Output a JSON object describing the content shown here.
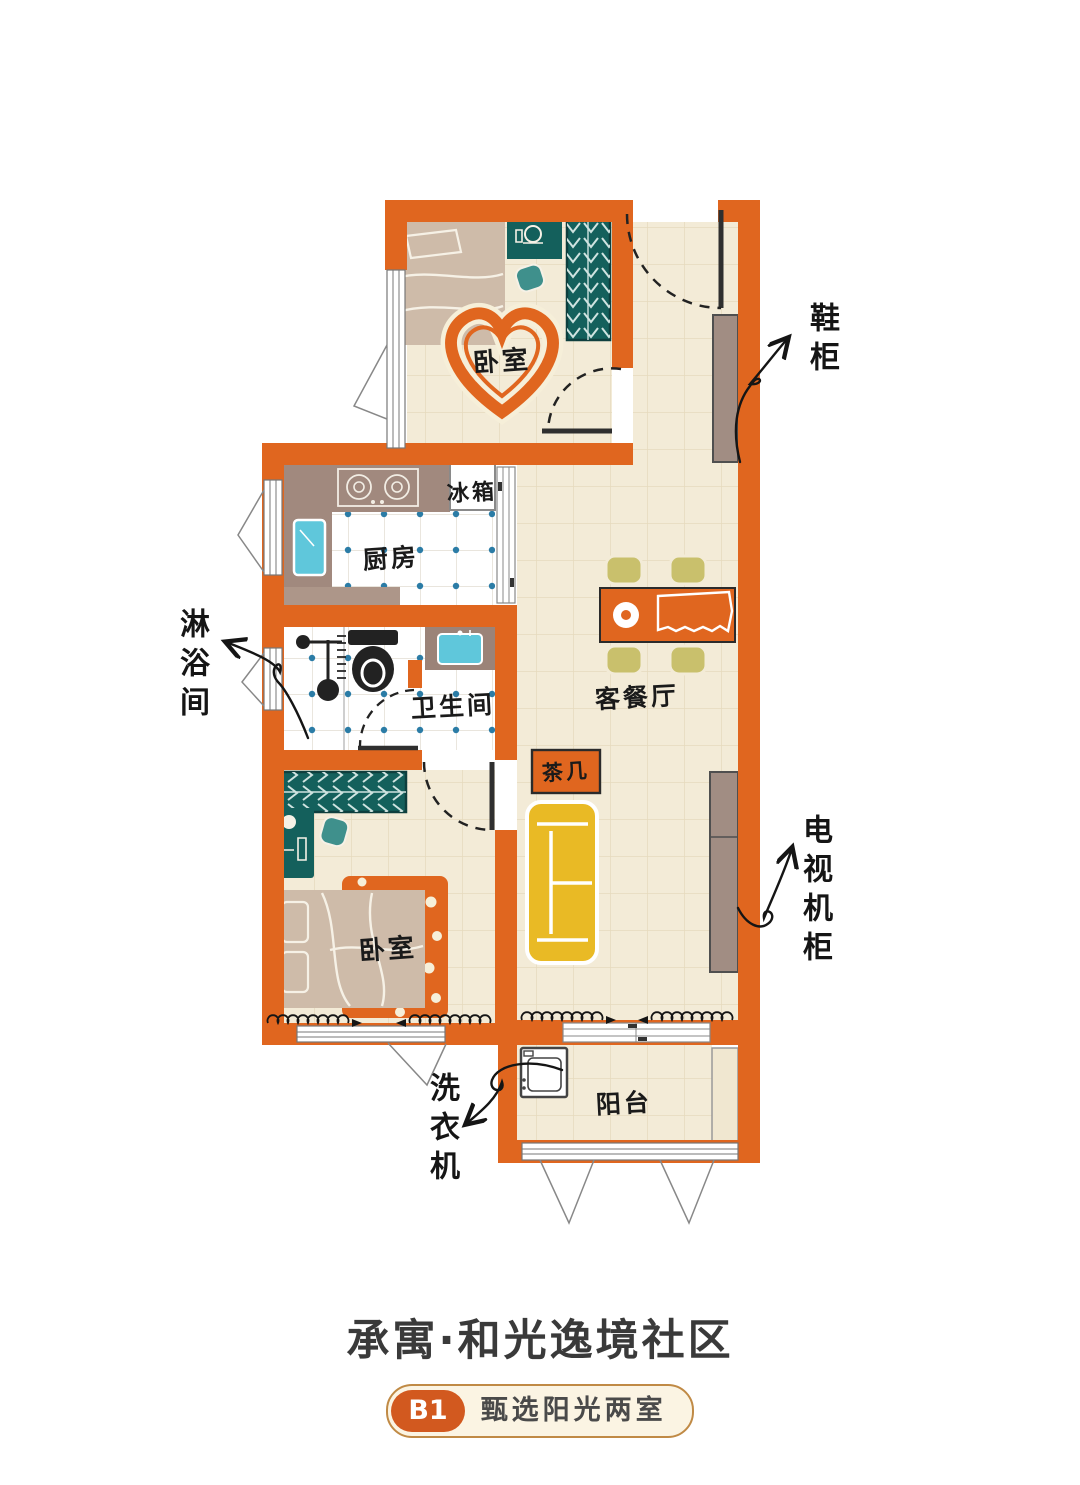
{
  "plan": {
    "rooms": {
      "bedroom_top": {
        "label": "卧室"
      },
      "bedroom_bottom": {
        "label": "卧室"
      },
      "kitchen": {
        "label": "厨房"
      },
      "bathroom": {
        "label": "卫生间"
      },
      "living_dining": {
        "label": "客餐厅"
      },
      "balcony": {
        "label": "阳台"
      }
    },
    "items": {
      "fridge": "冰箱",
      "tea_table": "茶几"
    },
    "callouts": {
      "shoe_cabinet": "鞋柜",
      "shower_room": "淋浴间",
      "tv_cabinet": "电视机柜",
      "washing_machine": "洗衣机"
    }
  },
  "footer": {
    "community_name": "承寓·和光逸境社区",
    "unit_code": "B1",
    "unit_desc": "甄选阳光两室"
  },
  "colors": {
    "wall_orange": "#E0661F",
    "floor_cream": "#F3EBD7",
    "tile_line": "#E6DABD",
    "wet_floor": "#FFFFFF",
    "wet_dot": "#2B7CA6",
    "counter_taupe": "#A1897E",
    "cabinet_taupe": "#A18D83",
    "teal_dark": "#14605C",
    "teal_chair": "#3F908C",
    "bed_beige": "#CEBBA9",
    "sofa_yellow": "#E9BA25",
    "chair_olive": "#C9C06C",
    "sink_cyan": "#5FC7DB",
    "ink": "#1A1A1A",
    "title_gray": "#3A3A3A",
    "badge_orange": "#D2591F",
    "badge_cream": "#FBF4E3"
  }
}
